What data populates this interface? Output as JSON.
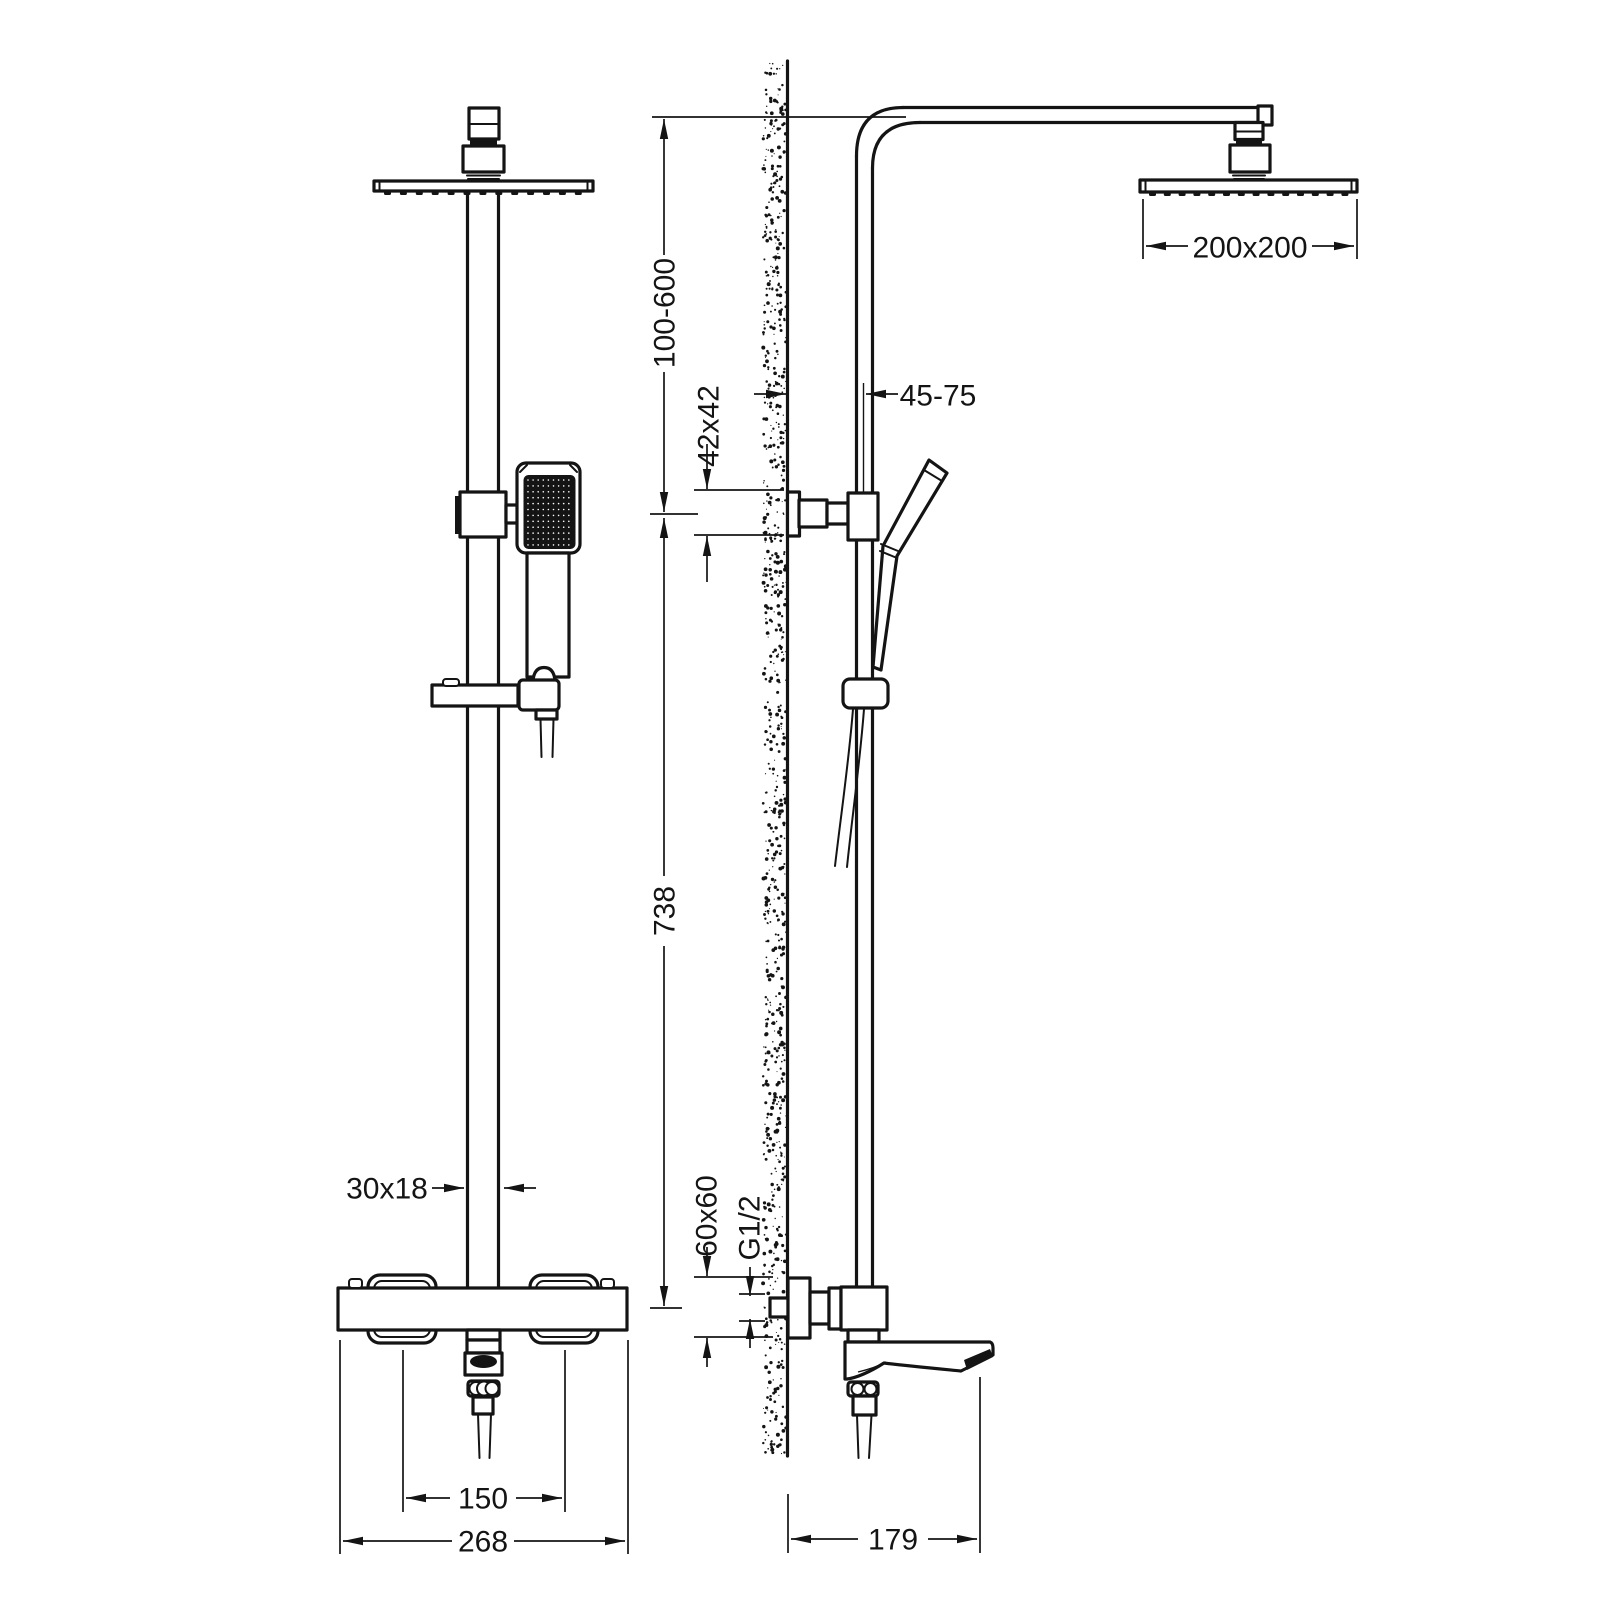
{
  "drawing": {
    "subject": "shower column technical drawing, front and side elevation",
    "colors": {
      "line": "#141414",
      "background": "#ffffff"
    },
    "dims": {
      "height_adjust": {
        "text": "100-600"
      },
      "bracket_size": {
        "text": "42x42"
      },
      "wall_distance": {
        "text": "45-75"
      },
      "head_size": {
        "text": "200x200"
      },
      "column_height": {
        "text": "738"
      },
      "pipe_profile": {
        "text": "30x18"
      },
      "valve_size": {
        "text": "60x60"
      },
      "thread": {
        "text": "G1/2"
      },
      "handle_distance": {
        "text": "150"
      },
      "valve_width": {
        "text": "268"
      },
      "spout_reach": {
        "text": "179"
      }
    }
  }
}
